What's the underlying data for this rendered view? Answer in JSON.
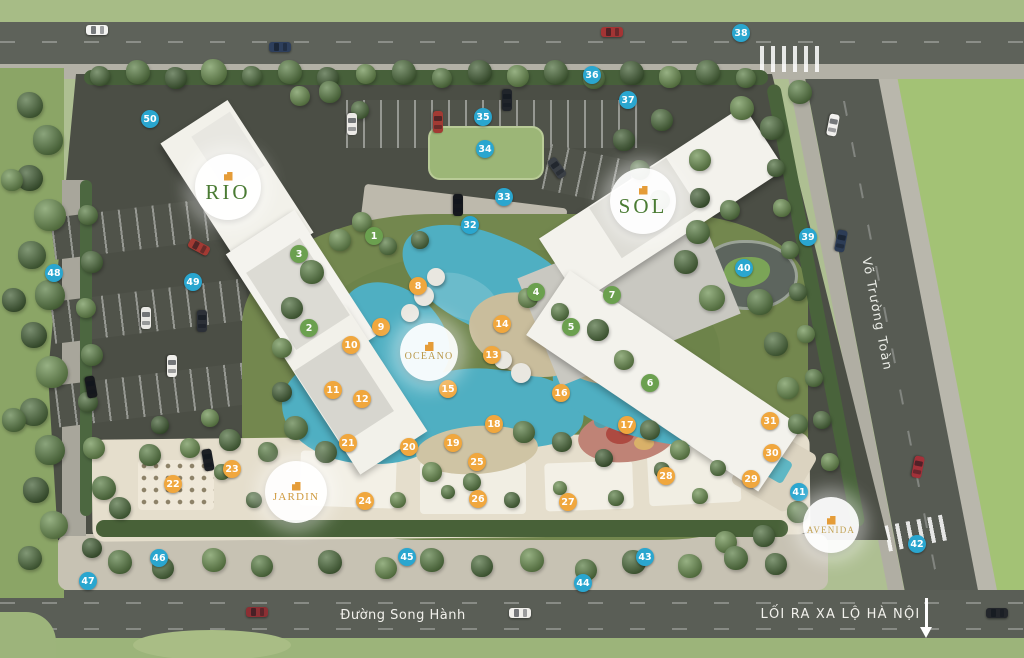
{
  "plan": {
    "name_circles": [
      {
        "id": "rio",
        "label": "RIO",
        "x": 228,
        "y": 187,
        "d": 66,
        "text_color": "#4a7b33",
        "font_px": 21
      },
      {
        "id": "sol",
        "label": "SOL",
        "x": 643,
        "y": 201,
        "d": 66,
        "text_color": "#4a7b33",
        "font_px": 21
      },
      {
        "id": "oceano",
        "label": "OCEANO",
        "x": 429,
        "y": 352,
        "d": 58,
        "text_color": "#b9984a",
        "font_px": 10
      },
      {
        "id": "jardin",
        "label": "JARDIN",
        "x": 296,
        "y": 492,
        "d": 62,
        "text_color": "#cf9a3e",
        "font_px": 11
      },
      {
        "id": "avenida",
        "label": "AVENIDA",
        "x": 831,
        "y": 525,
        "d": 56,
        "text_color": "#c2a253",
        "font_px": 9
      }
    ],
    "streets": {
      "bottom": "Đường Song Hành",
      "right": "Võ Trường Toàn",
      "exit_label": "LỐI RA XA LỘ HÀ NỘI"
    },
    "marker_colors": {
      "green": "#6ba04f",
      "orange": "#f0a73e",
      "blue": "#2aa6cf"
    },
    "markers": {
      "green": [
        {
          "n": 1,
          "x": 374,
          "y": 236
        },
        {
          "n": 2,
          "x": 309,
          "y": 328
        },
        {
          "n": 3,
          "x": 299,
          "y": 254
        },
        {
          "n": 4,
          "x": 536,
          "y": 292
        },
        {
          "n": 5,
          "x": 571,
          "y": 327
        },
        {
          "n": 6,
          "x": 650,
          "y": 383
        },
        {
          "n": 7,
          "x": 612,
          "y": 295
        }
      ],
      "orange": [
        {
          "n": 8,
          "x": 418,
          "y": 286
        },
        {
          "n": 9,
          "x": 381,
          "y": 327
        },
        {
          "n": 10,
          "x": 351,
          "y": 345
        },
        {
          "n": 11,
          "x": 333,
          "y": 390
        },
        {
          "n": 12,
          "x": 362,
          "y": 399
        },
        {
          "n": 13,
          "x": 492,
          "y": 355
        },
        {
          "n": 14,
          "x": 502,
          "y": 324
        },
        {
          "n": 15,
          "x": 448,
          "y": 389
        },
        {
          "n": 16,
          "x": 561,
          "y": 393
        },
        {
          "n": 17,
          "x": 627,
          "y": 425
        },
        {
          "n": 18,
          "x": 494,
          "y": 424
        },
        {
          "n": 19,
          "x": 453,
          "y": 443
        },
        {
          "n": 20,
          "x": 409,
          "y": 447
        },
        {
          "n": 21,
          "x": 348,
          "y": 443
        },
        {
          "n": 22,
          "x": 173,
          "y": 484
        },
        {
          "n": 23,
          "x": 232,
          "y": 469
        },
        {
          "n": 24,
          "x": 365,
          "y": 501
        },
        {
          "n": 25,
          "x": 477,
          "y": 462
        },
        {
          "n": 26,
          "x": 478,
          "y": 499
        },
        {
          "n": 27,
          "x": 568,
          "y": 502
        },
        {
          "n": 28,
          "x": 666,
          "y": 476
        },
        {
          "n": 29,
          "x": 751,
          "y": 479
        },
        {
          "n": 30,
          "x": 772,
          "y": 453
        },
        {
          "n": 31,
          "x": 770,
          "y": 421
        }
      ],
      "blue": [
        {
          "n": 32,
          "x": 470,
          "y": 225
        },
        {
          "n": 33,
          "x": 504,
          "y": 197
        },
        {
          "n": 34,
          "x": 485,
          "y": 149
        },
        {
          "n": 35,
          "x": 483,
          "y": 117
        },
        {
          "n": 36,
          "x": 592,
          "y": 75
        },
        {
          "n": 37,
          "x": 628,
          "y": 100
        },
        {
          "n": 38,
          "x": 741,
          "y": 33
        },
        {
          "n": 39,
          "x": 808,
          "y": 237
        },
        {
          "n": 40,
          "x": 744,
          "y": 268
        },
        {
          "n": 41,
          "x": 799,
          "y": 492
        },
        {
          "n": 42,
          "x": 917,
          "y": 544
        },
        {
          "n": 43,
          "x": 645,
          "y": 557
        },
        {
          "n": 44,
          "x": 583,
          "y": 583
        },
        {
          "n": 45,
          "x": 407,
          "y": 557
        },
        {
          "n": 46,
          "x": 159,
          "y": 558
        },
        {
          "n": 47,
          "x": 88,
          "y": 581
        },
        {
          "n": 48,
          "x": 54,
          "y": 273
        },
        {
          "n": 49,
          "x": 193,
          "y": 282
        },
        {
          "n": 50,
          "x": 150,
          "y": 119
        }
      ]
    }
  }
}
